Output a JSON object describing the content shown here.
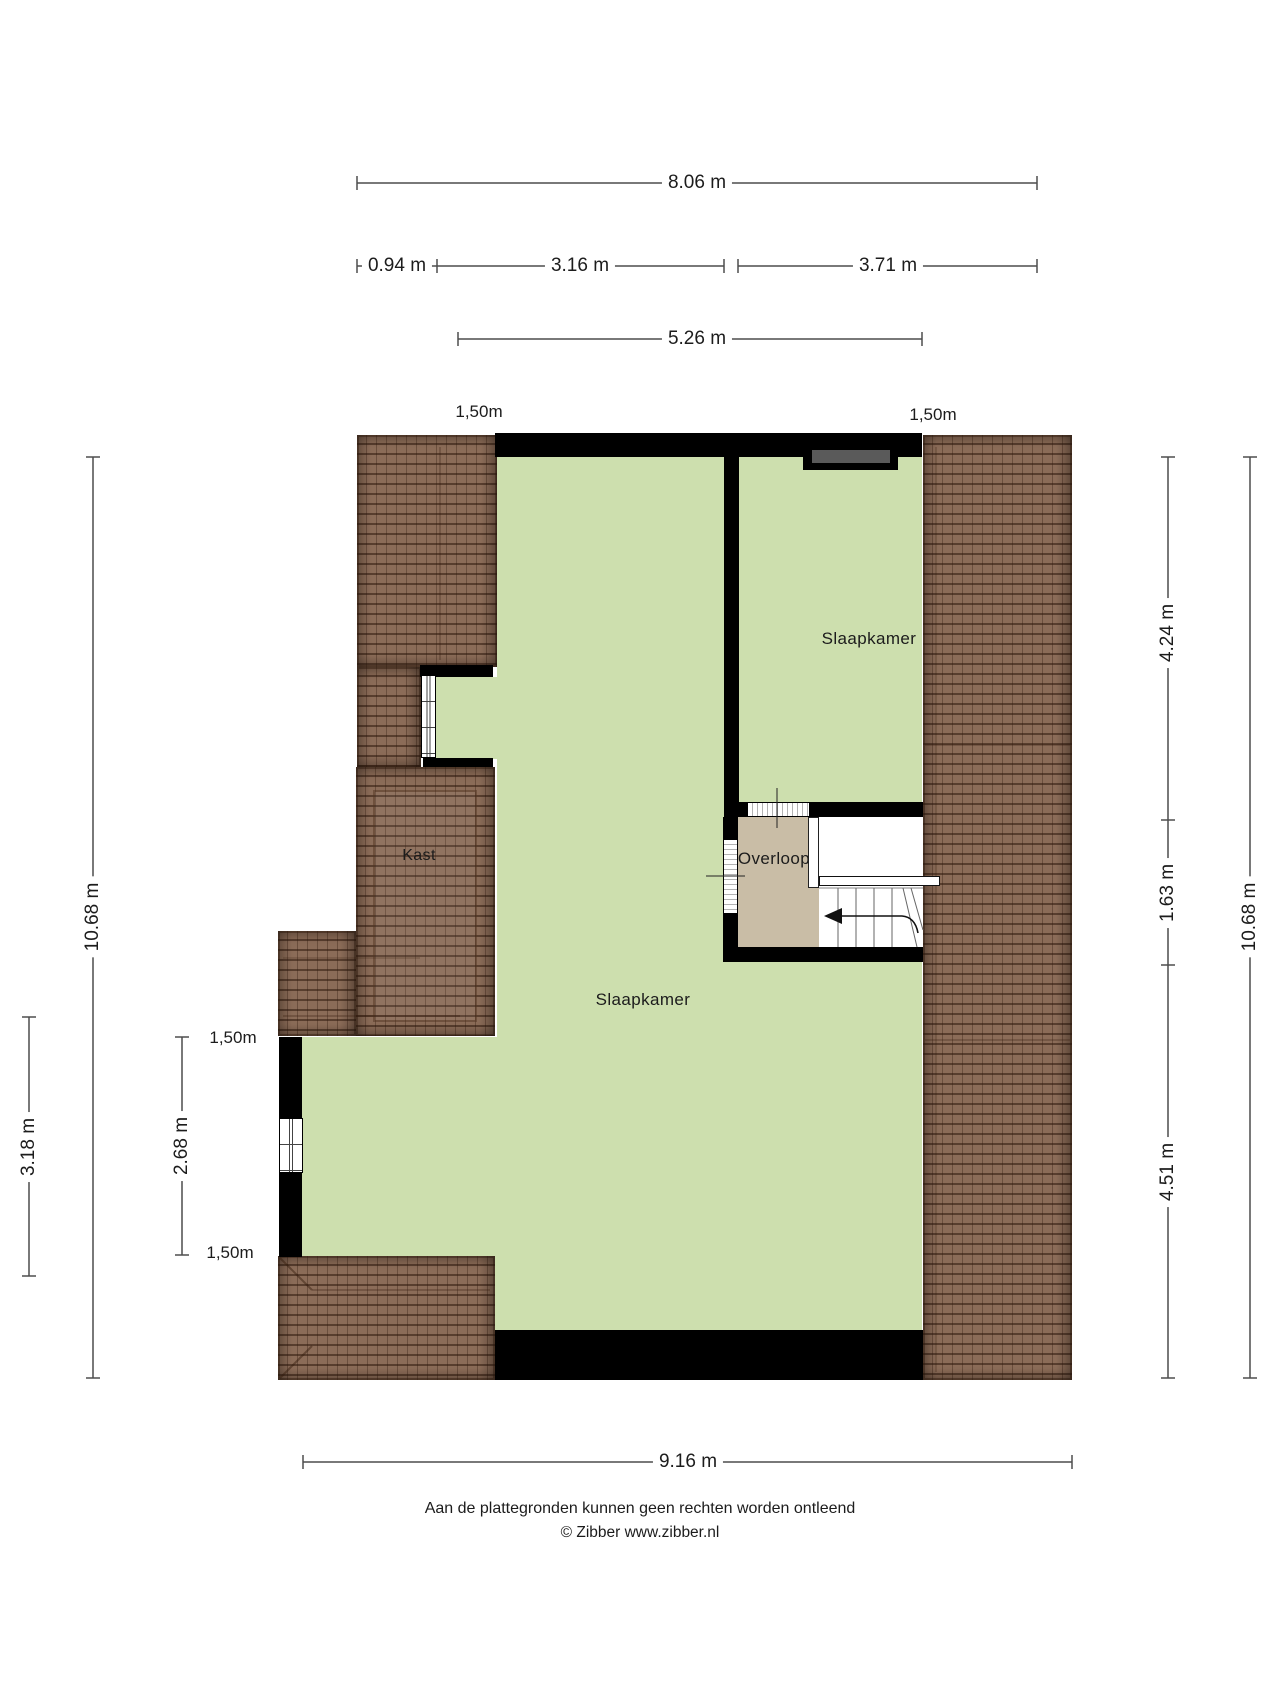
{
  "plan": {
    "rooms": {
      "bedroom_left": "Slaapkamer",
      "bedroom_right": "Slaapkamer",
      "closet": "Kast",
      "landing": "Overloop"
    },
    "headroom_labels": {
      "top_left": "1,50m",
      "top_right": "1,50m",
      "left_upper": "1,50m",
      "left_lower": "1,50m"
    },
    "dimensions": {
      "total_width_top": "8.06 m",
      "seg_left": "0.94 m",
      "seg_mid": "3.16 m",
      "seg_right": "3.71 m",
      "inner_width": "5.26 m",
      "left_height": "10.68 m",
      "left_lower_height": "3.18 m",
      "left_inner_height": "2.68 m",
      "right_upper": "4.24 m",
      "right_mid": "1.63 m",
      "right_lower": "4.51 m",
      "right_height": "10.68 m",
      "bottom_width": "9.16 m"
    }
  },
  "colors": {
    "floor": "#cddfae",
    "landing_floor": "#c9bda6",
    "roof": "#8b6c58",
    "wall": "#000000",
    "dormer": "#5a5a5a",
    "dimension_line": "#4d4d4d"
  },
  "footer": {
    "disclaimer": "Aan de plattegronden kunnen geen rechten worden ontleend",
    "copyright": "© Zibber www.zibber.nl"
  }
}
